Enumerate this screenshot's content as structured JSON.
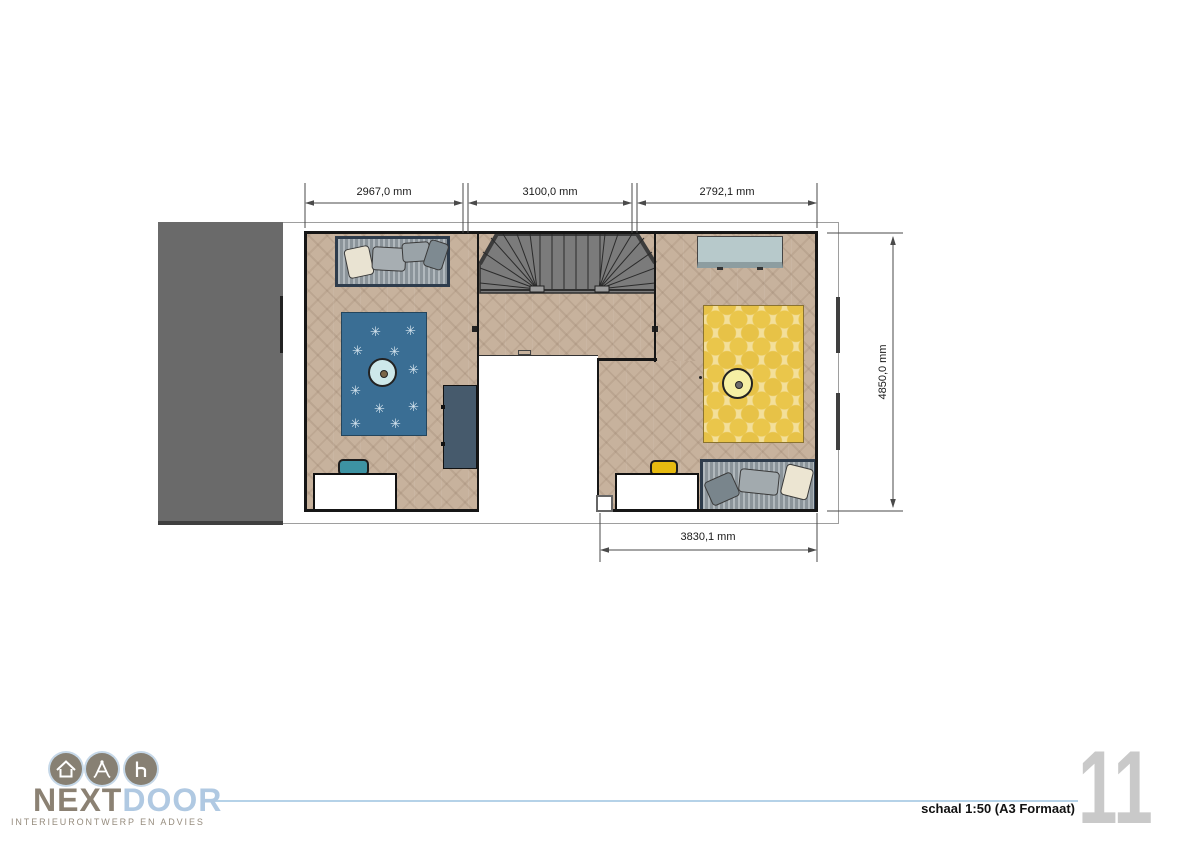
{
  "document": {
    "type": "interior floor plan sheet",
    "orientation": "landscape A3"
  },
  "plan": {
    "dimensions": {
      "top": [
        {
          "label": "2967,0 mm"
        },
        {
          "label": "3100,0 mm"
        },
        {
          "label": "2792,1 mm"
        }
      ],
      "right": {
        "label": "4850,0 mm"
      },
      "bottom": {
        "label": "3830,1 mm"
      }
    },
    "colors": {
      "floor_wood": "#c7b29d",
      "wall": "#161616",
      "stairs": "#7b7b7b",
      "side_block": "#6a6a6a",
      "rug_left": "#3a6e94",
      "rug_right": "#e9c44a",
      "wardrobe": "#465a6c",
      "dresser": "#b7c9cb",
      "chair_left": "#3d93a3",
      "chair_right": "#e6ba10",
      "bed": "#97a1a7",
      "table_left": "#cde8ea",
      "table_right": "#f6f0a4"
    },
    "left_room": {
      "rug": {
        "snowflake_glyph": "✳",
        "positions": [
          [
            28,
            12
          ],
          [
            63,
            11
          ],
          [
            10,
            31
          ],
          [
            47,
            32
          ],
          [
            66,
            50
          ],
          [
            8,
            71
          ],
          [
            32,
            89
          ],
          [
            66,
            87
          ],
          [
            8,
            104
          ],
          [
            48,
            104
          ]
        ]
      }
    }
  },
  "footer": {
    "brand": {
      "name_primary": "NEXT",
      "name_secondary": "DOOR",
      "tagline": "INTERIEURONTWERP EN  ADVIES",
      "icons": [
        "house-icon",
        "compass-icon",
        "chair-icon"
      ],
      "accent_blue": "#b5d2e8",
      "accent_taupe": "#8b8173"
    },
    "scale_note": "schaal 1:50 (A3 Formaat)",
    "page_number": "11"
  }
}
